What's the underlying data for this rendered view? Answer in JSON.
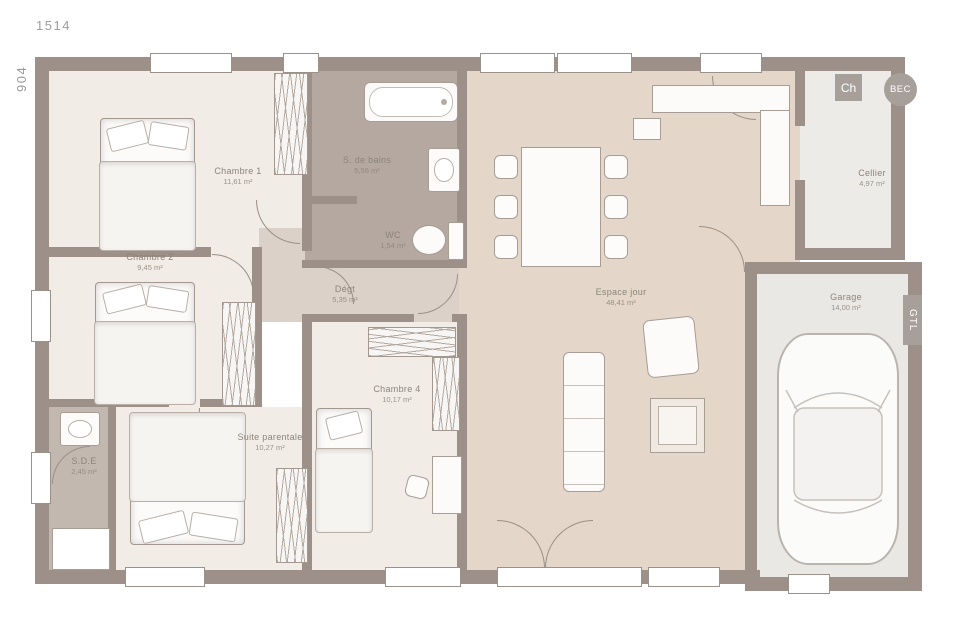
{
  "dims": {
    "width": "1514",
    "height": "904"
  },
  "rooms": {
    "chambre1": {
      "label": "Chambre 1",
      "area": "11,61 m²"
    },
    "chambre2": {
      "label": "Chambre 2",
      "area": "9,45 m²"
    },
    "sdb": {
      "label": "S. de bains",
      "area": "5,56 m²"
    },
    "wc": {
      "label": "WC",
      "area": "1,54 m²"
    },
    "degt": {
      "label": "Dégt",
      "area": "5,35 m²"
    },
    "espace_jour": {
      "label": "Espace jour",
      "area": "48,41 m²"
    },
    "cellier": {
      "label": "Cellier",
      "area": "4,97 m²"
    },
    "garage": {
      "label": "Garage",
      "area": "14,00 m²"
    },
    "chambre4": {
      "label": "Chambre 4",
      "area": "10,17 m²"
    },
    "suite": {
      "label": "Suite parentale",
      "area": "10,27 m²"
    },
    "sde": {
      "label": "S.D.E",
      "area": "2,45 m²"
    }
  },
  "badges": {
    "ch": "Ch",
    "bec": "BEC",
    "gtl": "GTL"
  },
  "colors": {
    "wall": "#9c9089",
    "bedroom_floor": "#f1ece6",
    "bath_floor": "#b4a8a0",
    "hall_floor": "#dbd1c8",
    "living_floor": "#e4d7c9",
    "cellier_floor": "#edebe8",
    "garage_floor": "#eae8e5",
    "badge_gray": "#a7a09a"
  }
}
